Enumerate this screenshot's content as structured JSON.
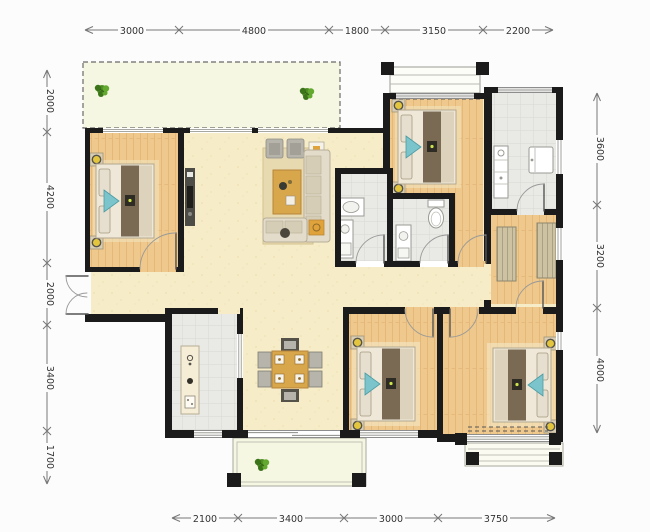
{
  "dimensions": {
    "top": [
      "3000",
      "4800",
      "1800",
      "3150",
      "2200"
    ],
    "bottom": [
      "2100",
      "3400",
      "3000",
      "3750"
    ],
    "left": [
      "2000",
      "4200",
      "2000",
      "3400",
      "1700"
    ],
    "right": [
      "3600",
      "3200",
      "4000"
    ]
  },
  "colors": {
    "wall": "#1b1b1b",
    "wood_floor": "#eec88c",
    "cream_floor": "#f6ecc8",
    "tile_floor": "#e9e9e6",
    "balcony_floor": "#f6f7e2",
    "rug": "#e8dab0",
    "table_wood": "#d8a74b",
    "chair_gray": "#b6b4ab",
    "chair_dark": "#55524a",
    "bed_dark": "#7a6a54",
    "bed_light": "#ddd3bd",
    "pillow": "#e6dfcf",
    "accent_cyan": "#7cc4cb",
    "lamp_yellow": "#e3c63e",
    "wardrobe_tan": "#cdc3a3",
    "plant_green": "#4f8f23",
    "dimension_line": "#777777",
    "dimension_text": "#333333"
  }
}
